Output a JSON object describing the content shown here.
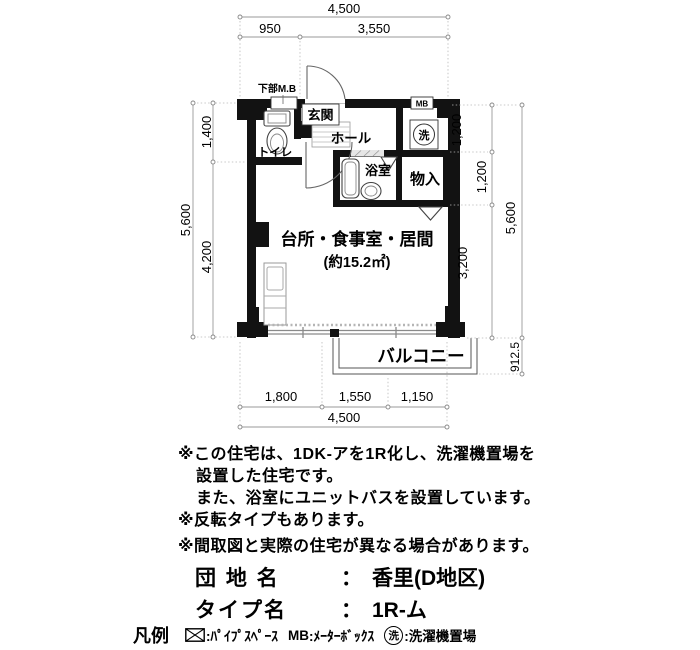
{
  "plan": {
    "room_labels": {
      "toilet": "トイレ",
      "entrance": "玄関",
      "hall": "ホール",
      "bath": "浴室",
      "closet": "物入",
      "main_room": "台所・食事室・居間",
      "main_room_area": "(約15.2㎡)",
      "balcony": "バルコニー"
    },
    "annotations": {
      "lower_mb": "下部M.B",
      "mb": "MB",
      "laundry": "洗"
    },
    "dimensions": {
      "top_total": "4,500",
      "top_left": "950",
      "top_right": "3,550",
      "left_total": "5,600",
      "left_upper": "1,400",
      "left_lower": "4,200",
      "right_upper": "1,200",
      "right_mid": "1,200",
      "right_lower": "3,200",
      "right_total": "5,600",
      "balcony_depth": "912.5",
      "bottom_left": "1,800",
      "bottom_mid": "1,550",
      "bottom_right": "1,150",
      "bottom_total": "4,500"
    }
  },
  "notes": {
    "lines": [
      "※この住宅は、1DK-アを1R化し、洗濯機置場を",
      "設置した住宅です。",
      "また、浴室にユニットバスを設置しています。",
      "※反転タイプもあります。",
      "※間取図と実際の住宅が異なる場合があります。"
    ]
  },
  "info": {
    "estate_label": "団 地 名",
    "separator": "：",
    "estate_value": "香里(D地区)",
    "type_label": "タイプ名",
    "type_value": "1R-ム"
  },
  "legend": {
    "title": "凡例",
    "pipe_space": {
      "label": ":ﾊﾟｲﾌﾟｽﾍﾟｰｽ"
    },
    "meter_box": {
      "prefix": "MB",
      "label": ":ﾒｰﾀｰﾎﾞｯｸｽ"
    },
    "laundry": {
      "symbol": "洗",
      "label": ":洗濯機置場"
    }
  },
  "colors": {
    "wall": "#121212",
    "dimension_line": "#999999",
    "text": "#000000"
  }
}
